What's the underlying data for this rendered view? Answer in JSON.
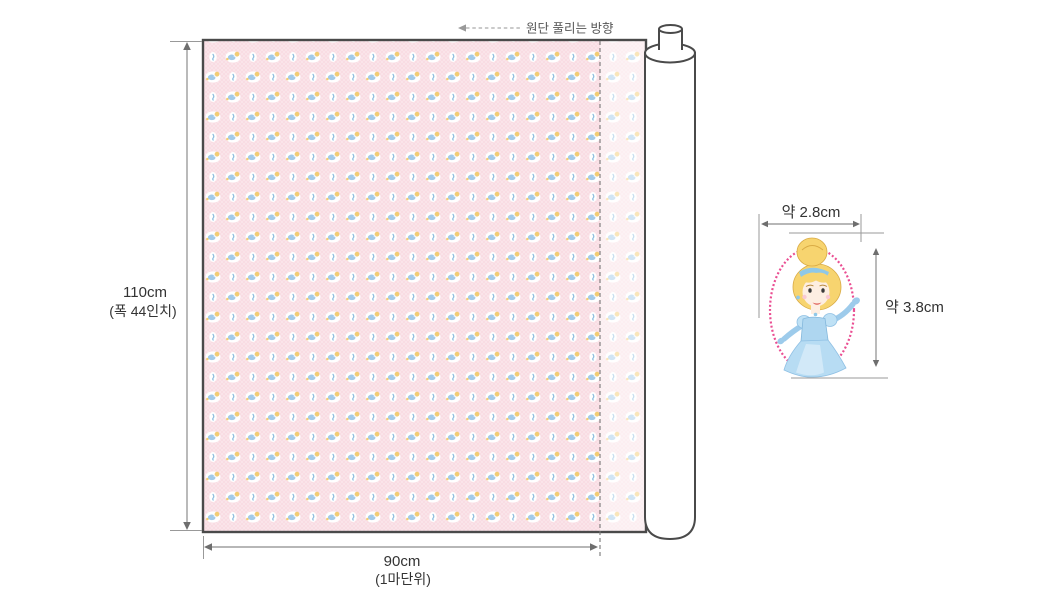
{
  "annotation": {
    "unroll_direction_label": "원단 풀리는 방향"
  },
  "fabric": {
    "width_label": "110cm",
    "width_sublabel": "(폭 44인치)",
    "length_label": "90cm",
    "length_sublabel": "(1마단위)",
    "pattern_description": "Cinderella cameo ovals and small charm ovals repeating on pink dotted ground, shown partly rolled on a white bolt",
    "colors": {
      "background_pink": "#f9dce3",
      "motif_blue": "#a3cbe8",
      "motif_yellow": "#f2cd74",
      "outline_dark": "#4a4a4a",
      "dimension_gray": "#8c8c8c"
    }
  },
  "motif_detail": {
    "width_label": "약 2.8cm",
    "height_label": "약 3.8cm",
    "character": "Cinderella",
    "frame_color": "#ea4e92",
    "dress_color": "#aed6f0",
    "glove_color": "#9dcbeb",
    "hair_color": "#f7d46f",
    "skin_color": "#fdeee2"
  }
}
